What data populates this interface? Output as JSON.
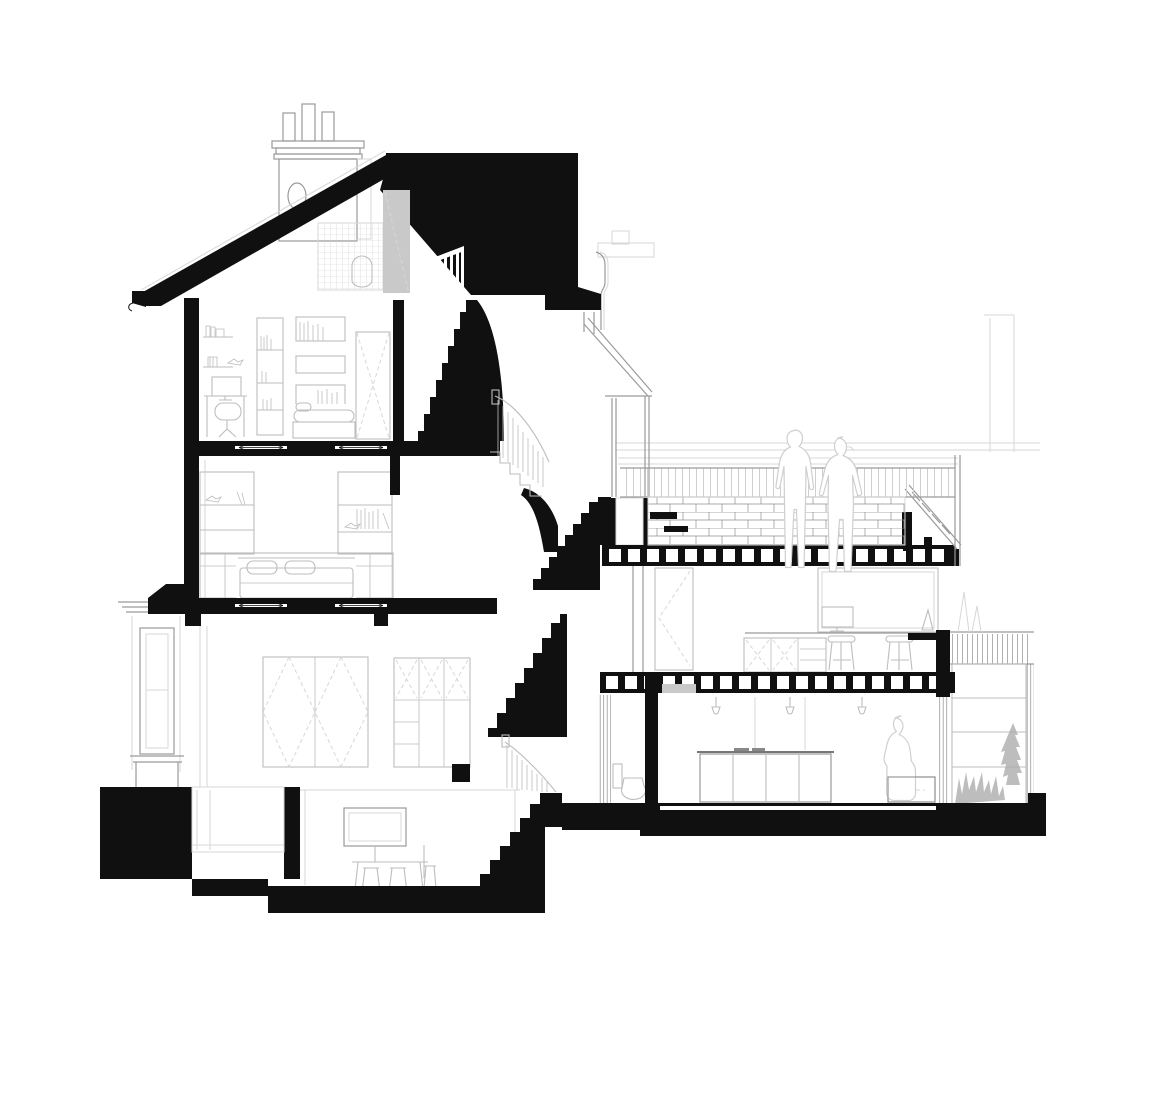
{
  "document": {
    "type": "architectural-section-drawing",
    "subject": "Cross-section of a multi-storey terraced house with loft, central staircase, rear extension, roof terrace and basement",
    "visible_text": "none",
    "background": "#ffffff"
  },
  "colors": {
    "ink": "#101010",
    "furniture_line": "#bdbdbd",
    "light_line": "#d7d7d7",
    "mid_line": "#9a9a9a",
    "panel_gray": "#c9c9c9",
    "plant_gray": "#adadad",
    "silhouette_line": "#cfcfcf",
    "brick_line": "#8f8f8f"
  },
  "structure": {
    "levels": [
      "basement",
      "ground-floor",
      "first-floor",
      "second-floor",
      "loft"
    ],
    "joist_bands": [
      {
        "group": "terrace-joists",
        "count": 18,
        "x": 609,
        "y": 549,
        "step": 19,
        "w": 12,
        "h": 13
      },
      {
        "group": "study-joists",
        "count": 18,
        "x": 606,
        "y": 676,
        "step": 19,
        "w": 12,
        "h": 13
      }
    ],
    "kitchen_sconces": [
      716,
      790,
      862
    ],
    "people": [
      {
        "location": "roof-terrace",
        "count": 2,
        "pose": "standing"
      },
      {
        "location": "kitchen",
        "count": 1,
        "pose": "standing"
      }
    ],
    "rooms": {
      "loft": [
        "desk",
        "monitor",
        "desk-chair",
        "bookcase",
        "wall-shelf-boxes",
        "bed",
        "door",
        "roof-bathroom-with-toilet"
      ],
      "second_floor": [
        "double-bed",
        "built-in-wardrobes",
        "shelf-units"
      ],
      "first_floor": [
        "bay-window",
        "folding-doors",
        "glazed-partition"
      ],
      "study": [
        "picture-window",
        "desk",
        "monitor",
        "stools",
        "low-cabinets",
        "door"
      ],
      "kitchen": [
        "kitchen-island",
        "wall-sconces",
        "bench",
        "wc-toilet"
      ],
      "basement": [
        "wall-screen",
        "table",
        "stools"
      ],
      "exterior": [
        "chimney-with-pots",
        "pitched-roof",
        "brick-parapet",
        "garden-glazing",
        "plants"
      ]
    }
  }
}
